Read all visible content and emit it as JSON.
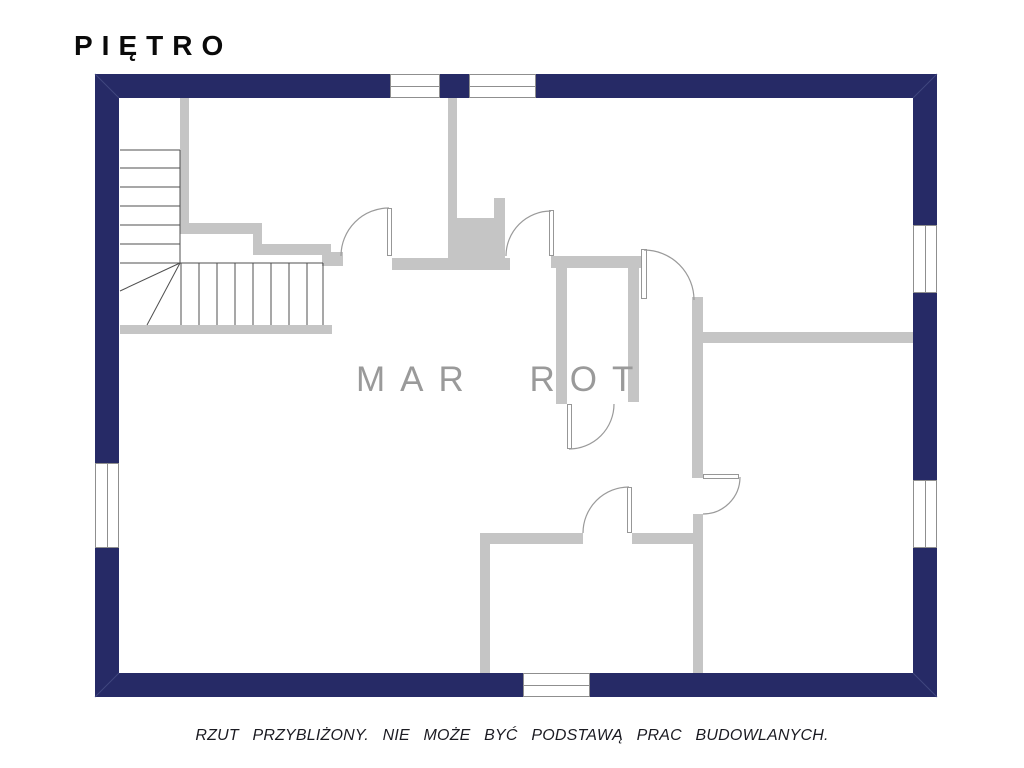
{
  "title": "P I Ę T R O",
  "title_plain": "PIĘTRO",
  "watermark": "MAR ROT",
  "caption": "RZUT PRZYBLIŻONY. NIE MOŻE BYĆ PODSTAWĄ PRAC BUDOWLANYCH.",
  "colors": {
    "outer_wall": "#262a66",
    "inner_wall": "#c5c5c5",
    "watermark": "#9a9a9a",
    "caption_text": "#1b1b22",
    "title_text": "#0a0a0a",
    "door_arc": "#9a9a9a",
    "stair_line": "#4f4f4f"
  },
  "floor_plan": {
    "outer_walls": [
      {
        "name": "outer-wall-north",
        "x": 95,
        "y": 74,
        "w": 842,
        "h": 24
      },
      {
        "name": "outer-wall-south",
        "x": 95,
        "y": 673,
        "w": 842,
        "h": 24
      },
      {
        "name": "outer-wall-west",
        "x": 95,
        "y": 74,
        "w": 24,
        "h": 623
      },
      {
        "name": "outer-wall-east",
        "x": 913,
        "y": 74,
        "w": 24,
        "h": 623
      }
    ],
    "inner_walls": [
      {
        "name": "stair-wall-vertical",
        "x": 180,
        "y": 97,
        "w": 9,
        "h": 127
      },
      {
        "name": "stair-wall-upper",
        "x": 180,
        "y": 223,
        "w": 82,
        "h": 11
      },
      {
        "name": "stair-wall-step",
        "x": 253,
        "y": 223,
        "w": 9,
        "h": 32
      },
      {
        "name": "stair-wall-lower",
        "x": 253,
        "y": 244,
        "w": 78,
        "h": 11
      },
      {
        "name": "hall-wall-stub",
        "x": 322,
        "y": 252,
        "w": 21,
        "h": 14
      },
      {
        "name": "chimney-wall",
        "x": 448,
        "y": 97,
        "w": 9,
        "h": 161
      },
      {
        "name": "chimney-block",
        "x": 455,
        "y": 218,
        "w": 41,
        "h": 40
      },
      {
        "name": "chimney-notch",
        "x": 494,
        "y": 198,
        "w": 11,
        "h": 60
      },
      {
        "name": "hall-wall-west-segment",
        "x": 392,
        "y": 258,
        "w": 118,
        "h": 12
      },
      {
        "name": "hall-wall-east-segment",
        "x": 551,
        "y": 256,
        "w": 91,
        "h": 12
      },
      {
        "name": "corridor-wall-west",
        "x": 556,
        "y": 268,
        "w": 11,
        "h": 136
      },
      {
        "name": "corridor-wall-east",
        "x": 628,
        "y": 268,
        "w": 11,
        "h": 134
      },
      {
        "name": "east-room-wall-upper",
        "x": 692,
        "y": 297,
        "w": 11,
        "h": 181
      },
      {
        "name": "east-room-wall-lower",
        "x": 693,
        "y": 514,
        "w": 10,
        "h": 159
      },
      {
        "name": "east-room-divider",
        "x": 703,
        "y": 332,
        "w": 210,
        "h": 11
      },
      {
        "name": "south-room-wall-west-segment",
        "x": 480,
        "y": 533,
        "w": 103,
        "h": 11
      },
      {
        "name": "south-room-wall-east-segment",
        "x": 632,
        "y": 533,
        "w": 61,
        "h": 11
      },
      {
        "name": "south-room-wall-vertical",
        "x": 480,
        "y": 544,
        "w": 10,
        "h": 129
      },
      {
        "name": "stair-base-wall",
        "x": 120,
        "y": 325,
        "w": 212,
        "h": 9
      }
    ],
    "windows": [
      {
        "name": "window-north-1",
        "x": 390,
        "y": 74,
        "w": 50,
        "h": 24,
        "dir": "h"
      },
      {
        "name": "window-north-2",
        "x": 469,
        "y": 74,
        "w": 67,
        "h": 24,
        "dir": "h"
      },
      {
        "name": "window-west",
        "x": 95,
        "y": 463,
        "w": 24,
        "h": 85,
        "dir": "v"
      },
      {
        "name": "window-east-1",
        "x": 913,
        "y": 225,
        "w": 24,
        "h": 68,
        "dir": "v"
      },
      {
        "name": "window-east-2",
        "x": 913,
        "y": 480,
        "w": 24,
        "h": 68,
        "dir": "v"
      },
      {
        "name": "window-south",
        "x": 523,
        "y": 673,
        "w": 67,
        "h": 24,
        "dir": "h"
      }
    ],
    "doors": [
      {
        "name": "door-hall-west",
        "leaf": {
          "x": 387,
          "y": 208,
          "w": 5,
          "h": 48
        },
        "arc": "M 389 208 A 48 48 0 0 0 341 256"
      },
      {
        "name": "door-hall-east",
        "leaf": {
          "x": 549,
          "y": 210,
          "w": 5,
          "h": 46
        },
        "arc": "M 551 211 A 45 45 0 0 0 506 256"
      },
      {
        "name": "door-northeast-room",
        "leaf": {
          "x": 641,
          "y": 249,
          "w": 6,
          "h": 50
        },
        "arc": "M 644 250 A 50 50 0 0 1 694 300"
      },
      {
        "name": "door-corridor-end",
        "leaf": {
          "x": 567,
          "y": 404,
          "w": 5,
          "h": 45
        },
        "arc": "M 614 404 A 45 45 0 0 1 569 449"
      },
      {
        "name": "door-east-room",
        "leaf": {
          "x": 703,
          "y": 474,
          "w": 36,
          "h": 5
        },
        "arc": "M 740 477 A 37 37 0 0 1 703 514"
      },
      {
        "name": "door-south-room",
        "leaf": {
          "x": 627,
          "y": 487,
          "w": 5,
          "h": 46
        },
        "arc": "M 629 487 A 46 46 0 0 0 583 533"
      }
    ],
    "stairs": {
      "tread_lines": [
        [
          120,
          150,
          180,
          150
        ],
        [
          120,
          168,
          180,
          168
        ],
        [
          120,
          187,
          180,
          187
        ],
        [
          120,
          206,
          180,
          206
        ],
        [
          120,
          225,
          180,
          225
        ],
        [
          120,
          244,
          180,
          244
        ],
        [
          180,
          150,
          180,
          263
        ],
        [
          120,
          263,
          180,
          263
        ],
        [
          180,
          263,
          120,
          291
        ],
        [
          180,
          263,
          147,
          325
        ],
        [
          180,
          263,
          323,
          263
        ],
        [
          181,
          263,
          181,
          325
        ],
        [
          199,
          263,
          199,
          325
        ],
        [
          217,
          263,
          217,
          325
        ],
        [
          235,
          263,
          235,
          325
        ],
        [
          253,
          263,
          253,
          325
        ],
        [
          271,
          263,
          271,
          325
        ],
        [
          289,
          263,
          289,
          325
        ],
        [
          307,
          263,
          307,
          325
        ],
        [
          323,
          263,
          323,
          325
        ]
      ]
    },
    "corner_miters": [
      [
        95,
        74,
        119,
        98
      ],
      [
        937,
        74,
        913,
        98
      ],
      [
        95,
        697,
        119,
        673
      ],
      [
        937,
        697,
        913,
        673
      ]
    ]
  }
}
